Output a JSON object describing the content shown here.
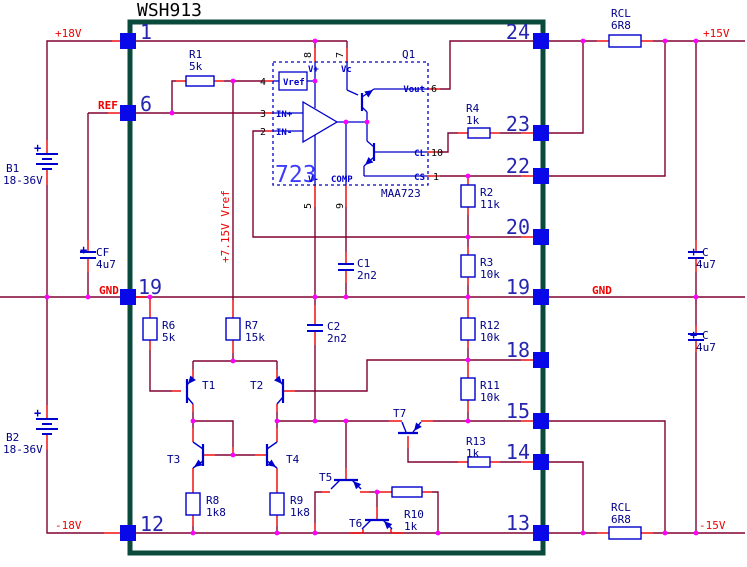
{
  "title": "WSH913",
  "colors": {
    "wire": "#800030",
    "lead": "#f00000",
    "component": "#0000cc",
    "navy": "#000087",
    "red": "#ee0000",
    "border": "#0a4a3c",
    "pin_square": "#0808e8",
    "junction": "#ff00ff",
    "pin_number": "#2626b0",
    "ic_big": "#3c3cff",
    "black": "#000000"
  },
  "pins": {
    "left": [
      "1",
      "6",
      "19",
      "12"
    ],
    "right": [
      "24",
      "23",
      "22",
      "20",
      "19",
      "18",
      "15",
      "14",
      "13"
    ]
  },
  "nets": {
    "p18v": "+18V",
    "ref": "REF",
    "gnd_left": "GND",
    "n18v": "-18V",
    "p15v": "+15V",
    "gnd_right": "GND",
    "n15v": "-15V",
    "vref_rail": "+7.15V Vref"
  },
  "batteries": [
    {
      "name": "B1",
      "value": "18-36V",
      "polarity": "+"
    },
    {
      "name": "B2",
      "value": "18-36V",
      "polarity": "+"
    }
  ],
  "resistors": [
    {
      "name": "R1",
      "value": "5k"
    },
    {
      "name": "R2",
      "value": "11k"
    },
    {
      "name": "R3",
      "value": "10k"
    },
    {
      "name": "R4",
      "value": "1k"
    },
    {
      "name": "R6",
      "value": "5k"
    },
    {
      "name": "R7",
      "value": "15k"
    },
    {
      "name": "R8",
      "value": "1k8"
    },
    {
      "name": "R9",
      "value": "1k8"
    },
    {
      "name": "R10",
      "value": "1k"
    },
    {
      "name": "R11",
      "value": "10k"
    },
    {
      "name": "R12",
      "value": "10k"
    },
    {
      "name": "R13",
      "value": "1k"
    },
    {
      "name": "RCL",
      "value": "6R8"
    },
    {
      "name": "RCL",
      "value": "6R8"
    }
  ],
  "capacitors": [
    {
      "name": "C1",
      "value": "2n2"
    },
    {
      "name": "C2",
      "value": "2n2"
    },
    {
      "name": "CF",
      "value": "4u7",
      "polarity": "+"
    },
    {
      "name": "C",
      "value": "4u7",
      "polarity": "+"
    },
    {
      "name": "C",
      "value": "4u7",
      "polarity": "+"
    }
  ],
  "transistors": [
    {
      "name": "T1"
    },
    {
      "name": "T2"
    },
    {
      "name": "T3"
    },
    {
      "name": "T4"
    },
    {
      "name": "T5"
    },
    {
      "name": "T6"
    },
    {
      "name": "T7"
    }
  ],
  "ic": {
    "label": "723",
    "part": "MAA723",
    "output_transistor": "Q1",
    "vref_block": "Vref",
    "signals": {
      "vplus": "V+",
      "vc": "Vc",
      "vout": "Vout",
      "in_plus": "IN+",
      "in_minus": "IN-",
      "vminus": "V-",
      "comp": "COMP",
      "cl": "CL",
      "cs": "CS"
    },
    "pin_numbers": {
      "p8": "8",
      "p7": "7",
      "p6": "6",
      "p10": "10",
      "p1": "1",
      "p5": "5",
      "p9": "9",
      "p4": "4",
      "p3": "3",
      "p2": "2"
    }
  }
}
